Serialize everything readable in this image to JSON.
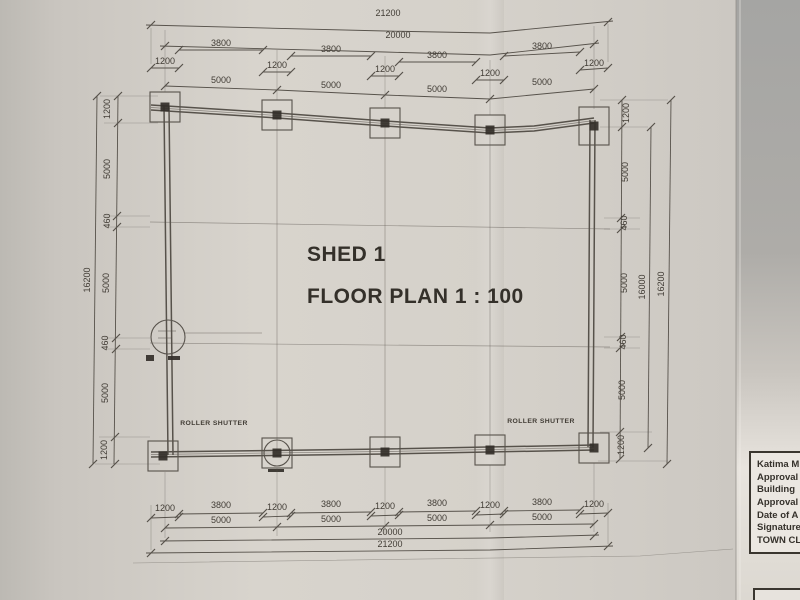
{
  "colors": {
    "bg": "#a7a7a5",
    "paper": "#d6d2cb",
    "line": "#57524b",
    "ink": "#413c35",
    "title-ink": "#34302a"
  },
  "drawing": {
    "title": {
      "line1": "SHED 1",
      "line2": "FLOOR PLAN 1 : 100"
    },
    "labels": {
      "roller_shutter_left": "ROLLER SHUTTER",
      "roller_shutter_right": "ROLLER SHUTTER"
    },
    "dims": {
      "top": {
        "overall": "21200",
        "span": "20000",
        "bays": [
          "3800",
          "3800",
          "3800",
          "3800"
        ],
        "cols": [
          "1200",
          "1200",
          "1200",
          "1200",
          "1200"
        ],
        "grid": [
          "5000",
          "5000",
          "5000",
          "5000"
        ]
      },
      "bottom": {
        "overall": "21200",
        "span": "20000",
        "bays": [
          "3800",
          "3800",
          "3800",
          "3800"
        ],
        "cols": [
          "1200",
          "1200",
          "1200",
          "1200",
          "1200"
        ],
        "grid": [
          "5000",
          "5000",
          "5000",
          "5000"
        ]
      },
      "left": {
        "overall": "16200",
        "chain": [
          "1200",
          "5000",
          "460",
          "5000",
          "460",
          "5000",
          "1200"
        ]
      },
      "right": {
        "overall": "16200",
        "span": "16000",
        "chain": [
          "1200",
          "5000",
          "460",
          "5000",
          "460",
          "5000",
          "1200"
        ]
      }
    }
  },
  "title_block": {
    "rows": [
      "Katima M",
      "Approval",
      "Building",
      "Approval",
      "Date of A",
      "Signature",
      "TOWN CL"
    ]
  }
}
